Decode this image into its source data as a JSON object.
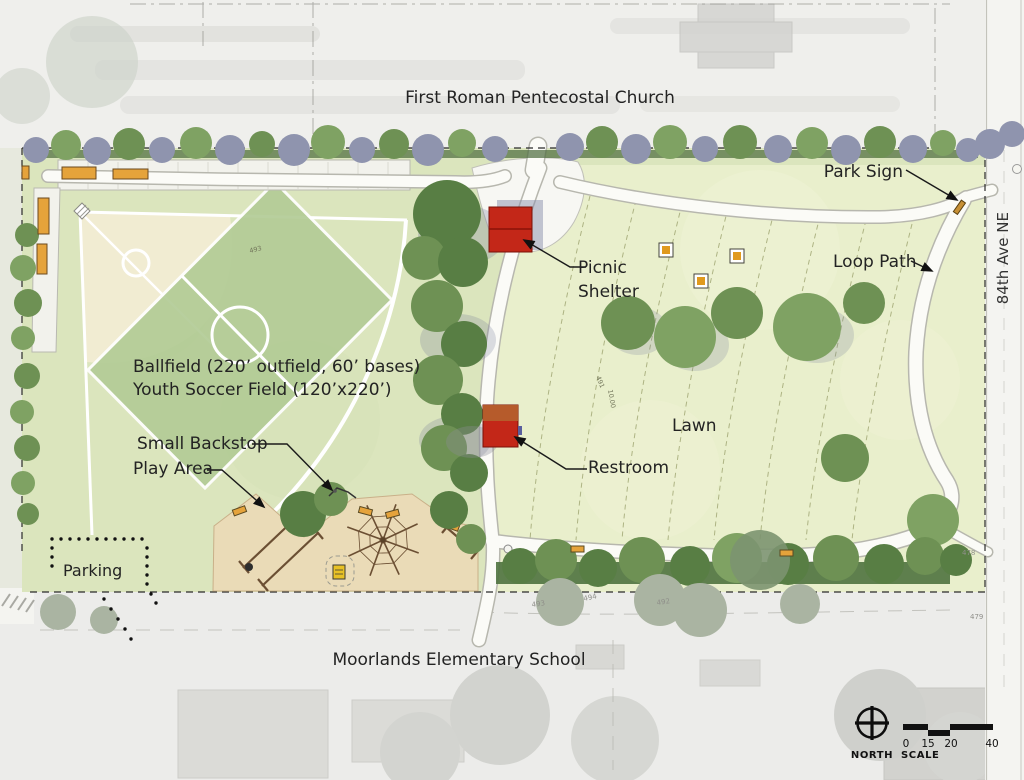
{
  "labels": {
    "church": "First Roman Pentecostal Church",
    "school": "Moorlands Elementary School",
    "street": "84th Ave NE",
    "park_sign": "Park Sign",
    "loop_path": "Loop Path",
    "picnic_shelter_line1": "Picnic",
    "picnic_shelter_line2": "Shelter",
    "restroom": "Restroom",
    "lawn": "Lawn",
    "ballfield": "Ballfield (220’ outfield, 60’ bases)",
    "soccer_field": "Youth Soccer Field (120’x220’)",
    "small_backstop": "Small Backstop",
    "play_area": "Play Area",
    "parking": "Parking"
  },
  "legend": {
    "north": "NORTH",
    "scale": "SCALE",
    "scale_ticks": [
      "0",
      "15",
      "20",
      "40"
    ]
  },
  "contour_labels": [
    {
      "t": "493"
    },
    {
      "t": "491"
    },
    {
      "t": "10.00"
    },
    {
      "t": "493"
    },
    {
      "t": "494"
    },
    {
      "t": "492"
    },
    {
      "t": "478"
    },
    {
      "t": "479"
    }
  ],
  "features": {
    "icons": [
      "north-compass-icon",
      "scale-bar",
      "picnic-table-icon",
      "bench-icon",
      "park-sign-icon",
      "backstop-icon",
      "swing-set-icon",
      "climber-net-icon"
    ]
  },
  "colors": {
    "park_green": "#dbe5bd",
    "lawn_green": "#e9efcc",
    "soccer_green": "#b3cc96",
    "infield_tan": "#f1ecd2",
    "play_sand": "#eadbb7",
    "building_red": "#c32718",
    "restroom_roof": "#b5622d",
    "bench_orange": "#e5a33b",
    "tree_green": "#6e9154",
    "tree_blue_gray": "#8f94ae",
    "hedge_green": "#4f7340",
    "path_white": "#fbfbf7",
    "surround_gray": "#ececea",
    "annotation_black": "#1a1a1a"
  }
}
